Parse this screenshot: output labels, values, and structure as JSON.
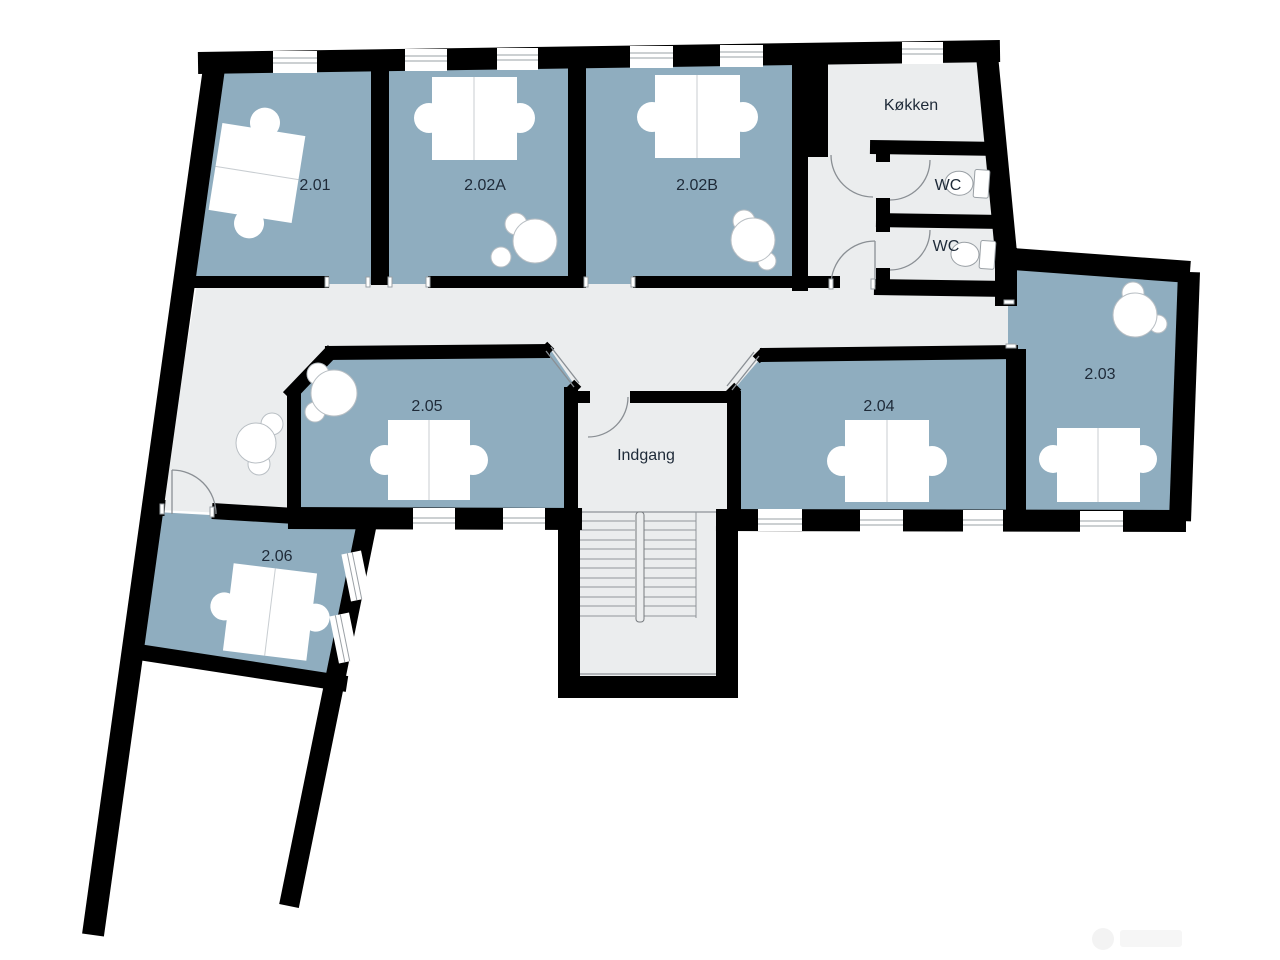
{
  "plan": {
    "type": "floor-plan",
    "language": "Danish",
    "colors": {
      "wall": "#000000",
      "room_fill": "#8fadbf",
      "circulation_fill": "#ebedee",
      "furniture": "#ffffff",
      "furniture_outline": "#b9bfc4",
      "label_text": "#1e2a38",
      "background": "#ffffff"
    },
    "rooms": [
      {
        "id": "2.01",
        "label": "2.01",
        "kind": "office",
        "furniture": [
          "desk",
          "chair",
          "chair"
        ]
      },
      {
        "id": "2.02A",
        "label": "2.02A",
        "kind": "office",
        "furniture": [
          "desk",
          "chair",
          "chair",
          "plant"
        ]
      },
      {
        "id": "2.02B",
        "label": "2.02B",
        "kind": "office",
        "furniture": [
          "desk",
          "chair",
          "chair",
          "plant"
        ]
      },
      {
        "id": "koekken",
        "label": "Køkken",
        "kind": "kitchen",
        "furniture": []
      },
      {
        "id": "wc-1",
        "label": "WC",
        "kind": "toilet",
        "furniture": [
          "toilet"
        ]
      },
      {
        "id": "wc-2",
        "label": "WC",
        "kind": "toilet",
        "furniture": [
          "toilet"
        ]
      },
      {
        "id": "2.03",
        "label": "2.03",
        "kind": "office",
        "furniture": [
          "desk",
          "chair",
          "chair",
          "plant"
        ]
      },
      {
        "id": "2.04",
        "label": "2.04",
        "kind": "office",
        "furniture": [
          "desk",
          "chair",
          "chair"
        ]
      },
      {
        "id": "2.05",
        "label": "2.05",
        "kind": "office",
        "furniture": [
          "desk",
          "chair",
          "chair",
          "plant"
        ]
      },
      {
        "id": "indgang",
        "label": "Indgang",
        "kind": "entrance",
        "furniture": [
          "stairs"
        ]
      },
      {
        "id": "2.06",
        "label": "2.06",
        "kind": "office",
        "furniture": [
          "desk",
          "chair",
          "chair"
        ]
      }
    ]
  }
}
